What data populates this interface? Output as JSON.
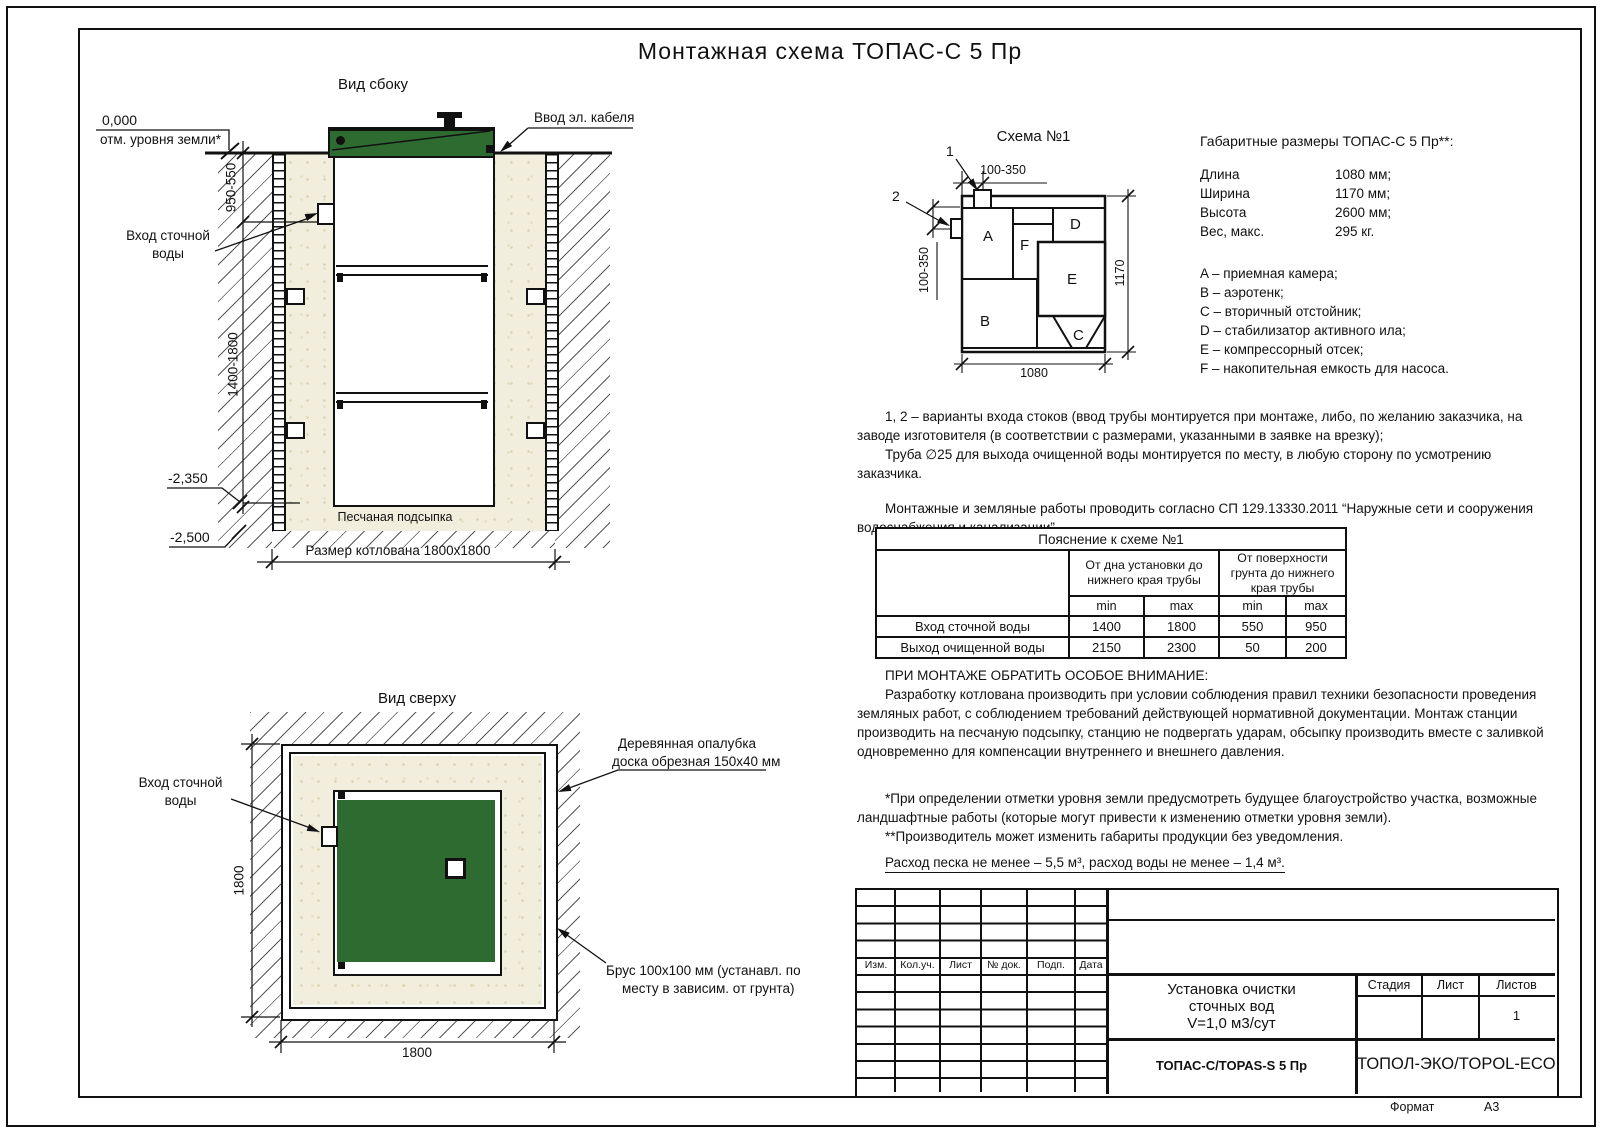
{
  "page": {
    "title": "Монтажная схема ТОПАС-С 5 Пр",
    "format_label": "Формат",
    "format_value": "А3"
  },
  "colors": {
    "lid_green": "#2e6b31",
    "sand_beige": "#f1eedd",
    "line_black": "#111111"
  },
  "side_view": {
    "title": "Вид сбоку",
    "zero_mark": "0,000",
    "zero_caption": "отм. уровня земли*",
    "cable_entry": "Ввод эл. кабеля",
    "inlet_l1": "Вход сточной",
    "inlet_l2": "воды",
    "dim_depth_top": "950-550",
    "dim_depth_bottom": "1400-1800",
    "level_tank_bottom": "-2,350",
    "level_pit_bottom": "-2,500",
    "sand_label": "Песчаная подсыпка",
    "pit_label": "Размер котлована 1800х1800"
  },
  "top_view": {
    "title": "Вид сверху",
    "inlet_l1": "Вход сточной",
    "inlet_l2": "воды",
    "dim_v": "1800",
    "dim_h": "1800",
    "formwork_l1": "Деревянная опалубка",
    "formwork_l2": "доска обрезная 150х40 мм",
    "beam_l1": "Брус 100х100 мм (устанавл. по",
    "beam_l2": "месту в зависим. от грунта)"
  },
  "schema": {
    "title": "Схема №1",
    "marker_1": "1",
    "marker_2": "2",
    "dim_top": "100-350",
    "dim_left": "100-350",
    "dim_width": "1080",
    "dim_height": "1170",
    "comp_a": "A",
    "comp_b": "B",
    "comp_c": "C",
    "comp_d": "D",
    "comp_e": "E",
    "comp_f": "F"
  },
  "specs": {
    "title": "Габаритные размеры ТОПАС-С 5 Пр**:",
    "rows": [
      {
        "label": "Длина",
        "value": "1080 мм;"
      },
      {
        "label": "Ширина",
        "value": "1170 мм;"
      },
      {
        "label": "Высота",
        "value": "2600 мм;"
      },
      {
        "label": "Вес, макс.",
        "value": "295 кг."
      }
    ],
    "legend": [
      "A – приемная камера;",
      "B – аэротенк;",
      "C – вторичный отстойник;",
      "D – стабилизатор активного ила;",
      "E – компрессорный отсек;",
      "F – накопительная емкость для насоса."
    ]
  },
  "notes": {
    "variants": "1, 2 – варианты входа  стоков (ввод трубы монтируется при монтаже, либо, по желанию заказчика, на заводе изготовителя (в соответствии с размерами, указанными в заявке на врезку);",
    "pipe": "Труба ∅25 для выхода очищенной воды монтируется по месту, в любую сторону по усмотрению заказчика.",
    "works": "Монтажные и земляные работы проводить согласно СП 129.13330.2011 “Наружные сети и сооружения водоснабжения и канализации”."
  },
  "table": {
    "title": "Пояснение к схеме №1",
    "col_group_1": "От дна установки до нижнего края трубы",
    "col_group_2": "От поверхности грунта до нижнего края трубы",
    "min_label": "min",
    "max_label": "max",
    "rows": [
      {
        "label": "Вход сточной воды",
        "v1": "1400",
        "v2": "1800",
        "v3": "550",
        "v4": "950"
      },
      {
        "label": "Выход очищенной воды",
        "v1": "2150",
        "v2": "2300",
        "v3": "50",
        "v4": "200"
      }
    ]
  },
  "attention": {
    "heading": "ПРИ МОНТАЖЕ ОБРАТИТЬ ОСОБОЕ ВНИМАНИЕ:",
    "body": "Разработку котлована производить при условии соблюдения правил техники безопасности проведения земляных работ, с соблюдением требований действующей нормативной документации. Монтаж станции производить на песчаную подсыпку, станцию не подвергать ударам, обсыпку производить вместе с заливкой одновременно для компенсации внутреннего и внешнего давления."
  },
  "footnotes": {
    "f1": "*При определении отметки уровня земли предусмотреть будущее благоустройство участка, возможные ландшафтные работы (которые могут привести к изменению отметки уровня земли).",
    "f2": "**Производитель может изменить габариты продукции без уведомления.",
    "consumption": "Расход песка не менее – 5,5 м³, расход воды не менее – 1,4 м³."
  },
  "title_block": {
    "cols": [
      "Изм.",
      "Кол.уч.",
      "Лист",
      "№ док.",
      "Подп.",
      "Дата"
    ],
    "doc_l1": "Установка очистки",
    "doc_l2": "сточных вод",
    "doc_l3": "V=1,0 м3/сут",
    "stage": "Стадия",
    "sheet": "Лист",
    "sheets": "Листов",
    "sheets_value": "1",
    "model": "ТОПАС-С/TOPAS-S 5 Пр",
    "company": "ТОПОЛ-ЭКО/TOPOL-ECO"
  }
}
